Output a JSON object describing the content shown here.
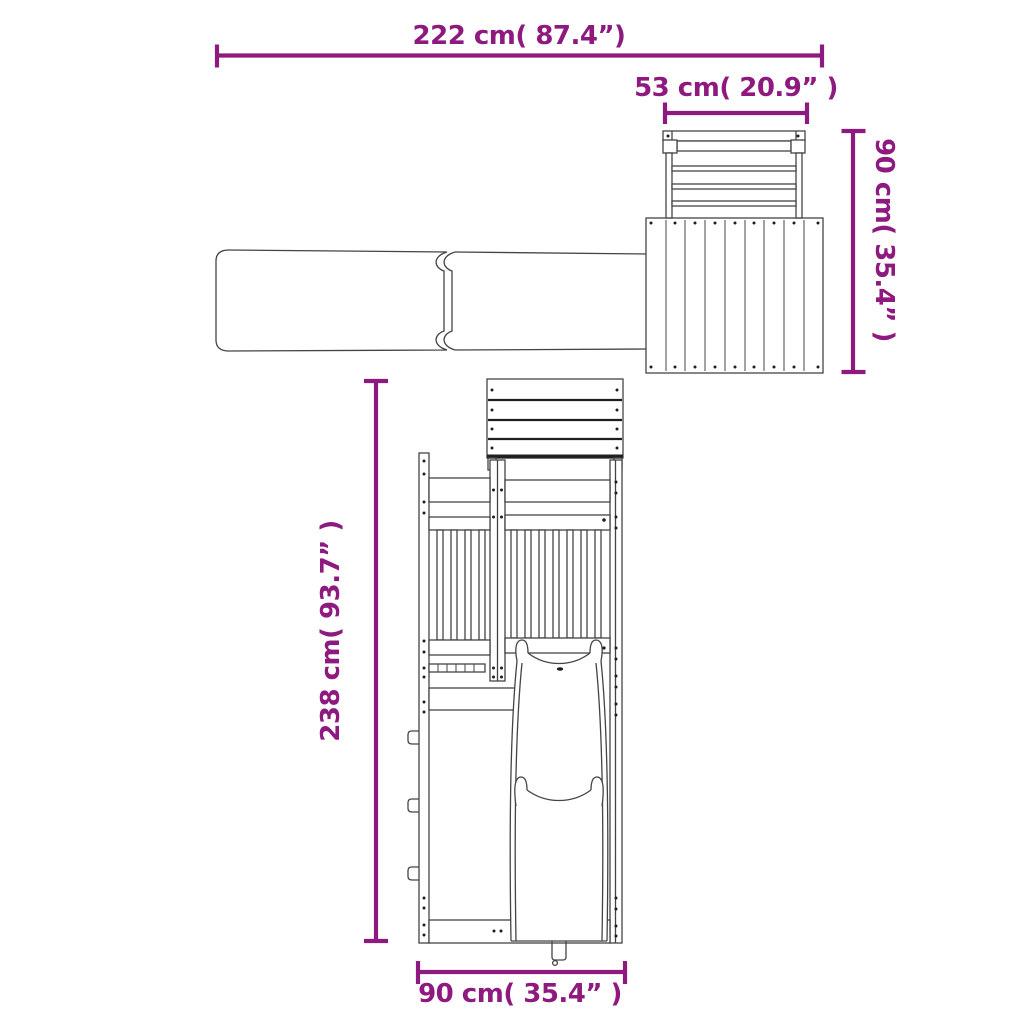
{
  "dimensions": {
    "overall_width": {
      "cm": "222",
      "inch": "87.4",
      "label": "222 cm( 87.4”)"
    },
    "top_depth": {
      "cm": "53",
      "inch": "20.9",
      "label": "53 cm( 20.9” )"
    },
    "side_height": {
      "cm": "90",
      "inch": "35.4",
      "label": "90 cm( 35.4” )"
    },
    "total_height": {
      "cm": "238",
      "inch": "93.7",
      "label": "238 cm( 93.7” )"
    },
    "base_width": {
      "cm": "90",
      "inch": "35.4",
      "label": "90 cm( 35.4” )"
    }
  },
  "colors": {
    "dimension_accent": "#8E1A80",
    "drawing_line": "#444444",
    "drawing_dark": "#1F1F1F",
    "background": "#FFFFFF"
  }
}
